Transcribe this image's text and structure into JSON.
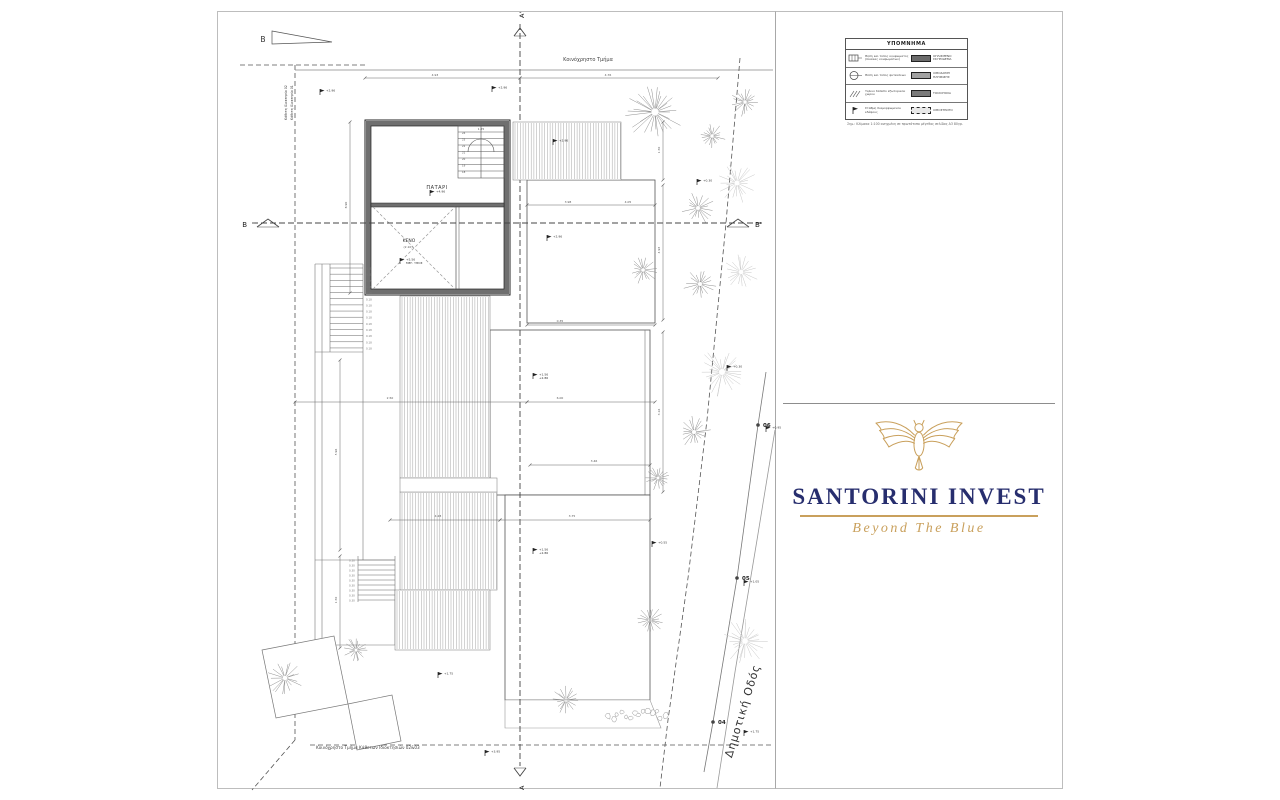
{
  "colors": {
    "page_border": "#bdbdbd",
    "line": "#555555",
    "wall_fill": "#6f6f6f",
    "hatch": "#9a9a9a",
    "navy": "#272e6e",
    "gold": "#c9a05c",
    "tree": "#8f8f8f",
    "tree_light": "#c8c8c8"
  },
  "legend": {
    "title": "ΥΠΟΜΝΗΜΑ",
    "rows": [
      {
        "sym": "window",
        "sym_label": "Θέση και τύπος κουφώματος (πίνακας κουφωμάτων)",
        "swatch": "#6b6b6b",
        "swatch_style": "solid",
        "swatch_label": "ΟΠΛΙΣΜΕΝΟ ΣΚΥΡΟΔΕΜΑ"
      },
      {
        "sym": "circle",
        "sym_label": "Θέση και τύπος φυτεύσεων",
        "swatch": "#a2a2a2",
        "swatch_style": "solid",
        "swatch_label": "ΛΙΘΟΔΟΜΗ ΠΛΗΡΩΣΗΣ"
      },
      {
        "sym": "hatch",
        "sym_label": "Ξύλινο δάπεδο εξωτερικού χώρου",
        "swatch": "#7a7a7a",
        "swatch_style": "solid",
        "swatch_label": "ΤΟΙΧΟΠΟΙΙΑ"
      },
      {
        "sym": "flag",
        "sym_label": "Στάθμη διαμορφωμένου εδάφους",
        "swatch": "#e8e8e8",
        "swatch_style": "stones",
        "swatch_label": "ΛΙΘΟΣΤΡΩΤΟ"
      }
    ],
    "note": "Σημ.: Κλίμακα 1:100 ανηγμένη σε πρωτότυπο μέγεθος σελίδας Α3 80γρ."
  },
  "logo": {
    "name": "SANTORINI INVEST",
    "tagline": "Beyond The Blue",
    "icon": "owl-icon"
  },
  "plan": {
    "labels": {
      "north": "B",
      "common_top": "Κοινόχρηστο Τμήμα",
      "vertical_property_02": "Κάθετη Ιδιοκτησία 02",
      "vertical_property_01": "Κάθετη Ιδιοκτησία 01",
      "patari": "ΠΑΤΑΡΙ",
      "keno": "ΚΕΝΟ",
      "road": "Δημοτική Οδός",
      "common_bottom": "Κοινόχρηστο Τμήμα Κάθετων Ιδιοκτησιών 02&03",
      "section_a": "A",
      "section_a_prime": "A'",
      "section_b": "B",
      "section_b_prime": "B'"
    },
    "boundary_points": [
      {
        "x": 758,
        "y": 425,
        "label": "06"
      },
      {
        "x": 737,
        "y": 578,
        "label": "05"
      },
      {
        "x": 713,
        "y": 722,
        "label": "04"
      }
    ],
    "trees": [
      {
        "x": 655,
        "y": 112,
        "r": 30,
        "light": false
      },
      {
        "x": 745,
        "y": 102,
        "r": 15,
        "light": false
      },
      {
        "x": 712,
        "y": 136,
        "r": 15,
        "light": false
      },
      {
        "x": 698,
        "y": 208,
        "r": 17,
        "light": false
      },
      {
        "x": 737,
        "y": 183,
        "r": 21,
        "light": true
      },
      {
        "x": 643,
        "y": 270,
        "r": 15,
        "light": false
      },
      {
        "x": 700,
        "y": 284,
        "r": 17,
        "light": false
      },
      {
        "x": 741,
        "y": 272,
        "r": 19,
        "light": true
      },
      {
        "x": 722,
        "y": 372,
        "r": 25,
        "light": true
      },
      {
        "x": 694,
        "y": 432,
        "r": 17,
        "light": false
      },
      {
        "x": 658,
        "y": 478,
        "r": 13,
        "light": false
      },
      {
        "x": 650,
        "y": 620,
        "r": 15,
        "light": false
      },
      {
        "x": 745,
        "y": 641,
        "r": 24,
        "light": true
      },
      {
        "x": 566,
        "y": 700,
        "r": 15,
        "light": false
      },
      {
        "x": 356,
        "y": 650,
        "r": 13,
        "light": false
      },
      {
        "x": 285,
        "y": 678,
        "r": 19,
        "light": false
      }
    ],
    "flags": [
      {
        "x": 320,
        "y": 95,
        "lines": [
          "+2.96"
        ]
      },
      {
        "x": 492,
        "y": 92,
        "lines": [
          "+2.96"
        ]
      },
      {
        "x": 697,
        "y": 185,
        "lines": [
          "+0.30"
        ]
      },
      {
        "x": 430,
        "y": 196,
        "lines": [
          "+4.96"
        ]
      },
      {
        "x": 400,
        "y": 264,
        "lines": [
          "+5.56",
          "ΜΕΓ. ΥΨΟΣ"
        ]
      },
      {
        "x": 553,
        "y": 145,
        "lines": [
          "+2.96"
        ]
      },
      {
        "x": 547,
        "y": 241,
        "lines": [
          "+2.96"
        ]
      },
      {
        "x": 533,
        "y": 379,
        "lines": [
          "+1.56",
          "+2.86"
        ]
      },
      {
        "x": 727,
        "y": 371,
        "lines": [
          "+0.30"
        ]
      },
      {
        "x": 533,
        "y": 554,
        "lines": [
          "+1.56",
          "+2.86"
        ]
      },
      {
        "x": 652,
        "y": 547,
        "lines": [
          "+0.55"
        ]
      },
      {
        "x": 438,
        "y": 678,
        "lines": [
          "+1.75"
        ]
      },
      {
        "x": 485,
        "y": 756,
        "lines": [
          "+3.95"
        ]
      },
      {
        "x": 744,
        "y": 736,
        "lines": [
          "+1.75"
        ]
      },
      {
        "x": 766,
        "y": 432,
        "lines": [
          "+0.95"
        ]
      },
      {
        "x": 744,
        "y": 586,
        "lines": [
          "+1.05"
        ]
      }
    ],
    "dims": [
      {
        "x": 435,
        "y": 76,
        "text": "4.93"
      },
      {
        "x": 608,
        "y": 76,
        "text": "4.76"
      },
      {
        "x": 568,
        "y": 203,
        "text": "3.98"
      },
      {
        "x": 628,
        "y": 203,
        "text": "4.05"
      },
      {
        "x": 337,
        "y": 452,
        "rot": -90,
        "text": "5.96"
      },
      {
        "x": 347,
        "y": 205,
        "rot": -90,
        "text": "8.90"
      },
      {
        "x": 660,
        "y": 150,
        "rot": -90,
        "text": "1.50"
      },
      {
        "x": 660,
        "y": 250,
        "rot": -90,
        "text": "4.93"
      },
      {
        "x": 660,
        "y": 412,
        "rot": -90,
        "text": "3.16"
      },
      {
        "x": 438,
        "y": 517,
        "text": "4.28"
      },
      {
        "x": 572,
        "y": 517,
        "text": "3.75"
      },
      {
        "x": 390,
        "y": 399,
        "text": "2.50"
      },
      {
        "x": 560,
        "y": 399,
        "text": "6.00"
      },
      {
        "x": 594,
        "y": 462,
        "text": "3.46"
      },
      {
        "x": 408,
        "y": 248,
        "text": "(2.10)"
      },
      {
        "x": 481,
        "y": 130,
        "text": "1.25"
      },
      {
        "x": 560,
        "y": 322,
        "text": "0.35"
      },
      {
        "x": 337,
        "y": 600,
        "rot": -90,
        "text": "1.50"
      }
    ],
    "stair_step_numbers": [
      "24",
      "23",
      "22",
      "21",
      "20",
      "19",
      "18"
    ],
    "stair_riser_label": "0.18",
    "lower_stair_label": "0.30"
  }
}
